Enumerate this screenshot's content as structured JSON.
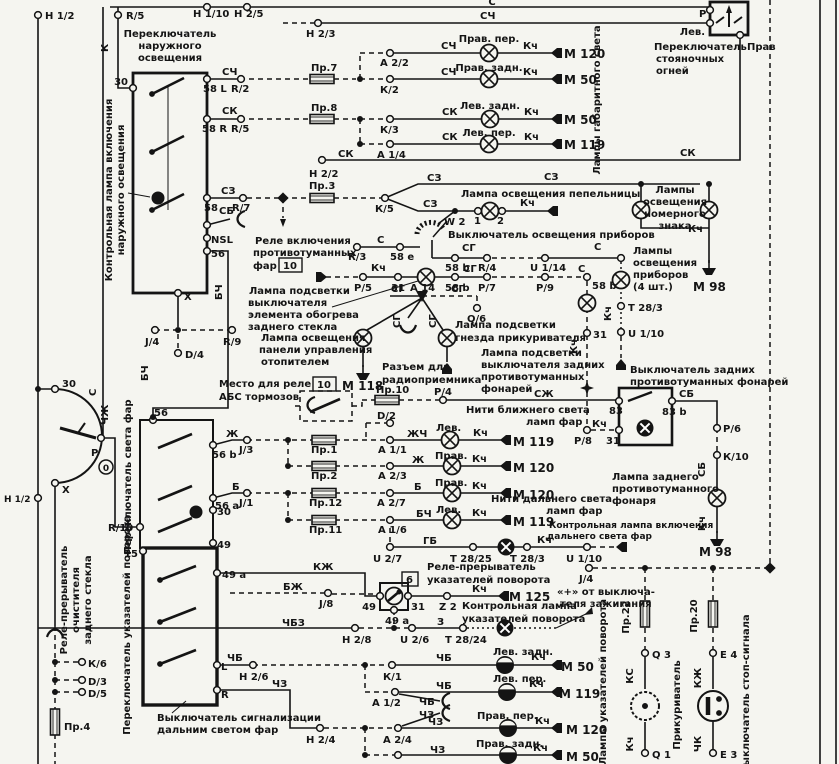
{
  "diagram": {
    "type": "automotive-wiring-schematic",
    "language": "ru",
    "line_color": "#141414",
    "paper_color": "#f5f5f0"
  },
  "labels": [
    {
      "t": "Н 1/2",
      "x": 45,
      "y": 19
    },
    {
      "t": "R/5",
      "x": 126,
      "y": 19
    },
    {
      "t": "К",
      "x": 108,
      "y": 52,
      "r": -90
    },
    {
      "t": "Переключатель",
      "x": 170,
      "y": 37,
      "a": "m"
    },
    {
      "t": "наружного",
      "x": 170,
      "y": 49,
      "a": "m"
    },
    {
      "t": "освещения",
      "x": 170,
      "y": 61,
      "a": "m"
    },
    {
      "t": "30",
      "x": 128,
      "y": 85,
      "a": "e"
    },
    {
      "t": "С",
      "x": 492,
      "y": 5,
      "a": "m"
    },
    {
      "t": "Н 1/10",
      "x": 193,
      "y": 17
    },
    {
      "t": "Н 2/5",
      "x": 234,
      "y": 17
    },
    {
      "t": "СЧ",
      "x": 480,
      "y": 19
    },
    {
      "t": "Н 2/3",
      "x": 306,
      "y": 37
    },
    {
      "t": "СЧ",
      "x": 222,
      "y": 75
    },
    {
      "t": "58 L",
      "x": 203,
      "y": 92
    },
    {
      "t": "R/2",
      "x": 231,
      "y": 92
    },
    {
      "t": "СК",
      "x": 222,
      "y": 114
    },
    {
      "t": "58 R",
      "x": 202,
      "y": 132
    },
    {
      "t": "R/5",
      "x": 231,
      "y": 132
    },
    {
      "t": "СЗ",
      "x": 221,
      "y": 194
    },
    {
      "t": "58",
      "x": 204,
      "y": 211
    },
    {
      "t": "R/7",
      "x": 232,
      "y": 211
    },
    {
      "t": "СБ",
      "x": 219,
      "y": 214
    },
    {
      "t": "NSL",
      "x": 211,
      "y": 243
    },
    {
      "t": "56",
      "x": 211,
      "y": 257
    },
    {
      "t": "X",
      "x": 184,
      "y": 300
    },
    {
      "t": "Контрольная лампа включения",
      "x": 112,
      "y": 190,
      "r": -90,
      "a": "m"
    },
    {
      "t": "наружного освещения",
      "x": 124,
      "y": 190,
      "r": -90,
      "a": "m"
    },
    {
      "t": "Пр.7",
      "x": 311,
      "y": 71
    },
    {
      "t": "А 2/2",
      "x": 380,
      "y": 66
    },
    {
      "t": "СЧ",
      "x": 441,
      "y": 49
    },
    {
      "t": "Прав. пер.",
      "x": 489,
      "y": 42,
      "a": "m"
    },
    {
      "t": "Кч",
      "x": 523,
      "y": 49
    },
    {
      "t": "М 120",
      "x": 564,
      "y": 58,
      "s": 12
    },
    {
      "t": "Прав. задн.",
      "x": 489,
      "y": 71,
      "a": "m"
    },
    {
      "t": "К/2",
      "x": 380,
      "y": 93
    },
    {
      "t": "СЧ",
      "x": 441,
      "y": 75
    },
    {
      "t": "Кч",
      "x": 523,
      "y": 75
    },
    {
      "t": "М 50",
      "x": 564,
      "y": 84,
      "s": 12
    },
    {
      "t": "Пр.8",
      "x": 311,
      "y": 111
    },
    {
      "t": "Лев. задн.",
      "x": 490,
      "y": 109,
      "a": "m"
    },
    {
      "t": "К/3",
      "x": 380,
      "y": 133
    },
    {
      "t": "СК",
      "x": 442,
      "y": 115
    },
    {
      "t": "Кч",
      "x": 524,
      "y": 115
    },
    {
      "t": "М 50",
      "x": 564,
      "y": 124,
      "s": 12
    },
    {
      "t": "Лев. пер.",
      "x": 489,
      "y": 136,
      "a": "m"
    },
    {
      "t": "А 1/4",
      "x": 377,
      "y": 158
    },
    {
      "t": "СК",
      "x": 442,
      "y": 140
    },
    {
      "t": "Кч",
      "x": 524,
      "y": 140
    },
    {
      "t": "М 119",
      "x": 564,
      "y": 149,
      "s": 12
    },
    {
      "t": "СК",
      "x": 338,
      "y": 157
    },
    {
      "t": "Н 2/2",
      "x": 309,
      "y": 177
    },
    {
      "t": "Лампы габаритного света",
      "x": 600,
      "y": 100,
      "r": -90,
      "a": "m"
    },
    {
      "t": "Лев.",
      "x": 705,
      "y": 35,
      "a": "e"
    },
    {
      "t": "Переключатель",
      "x": 654,
      "y": 50
    },
    {
      "t": "стояночных",
      "x": 656,
      "y": 62
    },
    {
      "t": "огней",
      "x": 656,
      "y": 74
    },
    {
      "t": "Прав",
      "x": 747,
      "y": 50
    },
    {
      "t": "Р",
      "x": 699,
      "y": 17
    },
    {
      "t": "СК",
      "x": 680,
      "y": 156
    },
    {
      "t": "Пр.3",
      "x": 309,
      "y": 189
    },
    {
      "t": "К/5",
      "x": 375,
      "y": 212
    },
    {
      "t": "СЗ",
      "x": 427,
      "y": 181
    },
    {
      "t": "СЗ",
      "x": 423,
      "y": 207
    },
    {
      "t": "Лампа освещения пепельницы",
      "x": 461,
      "y": 197
    },
    {
      "t": "СЗ",
      "x": 544,
      "y": 180
    },
    {
      "t": "W 2",
      "x": 444,
      "y": 225
    },
    {
      "t": "1",
      "x": 474,
      "y": 224
    },
    {
      "t": "2",
      "x": 497,
      "y": 224
    },
    {
      "t": "Кч",
      "x": 520,
      "y": 206
    },
    {
      "t": "Выключатель освещения приборов",
      "x": 448,
      "y": 238
    },
    {
      "t": "С",
      "x": 377,
      "y": 243
    },
    {
      "t": "R/3",
      "x": 348,
      "y": 260
    },
    {
      "t": "58 е",
      "x": 390,
      "y": 260
    },
    {
      "t": "СГ",
      "x": 462,
      "y": 251
    },
    {
      "t": "58 b",
      "x": 445,
      "y": 271
    },
    {
      "t": "R/4",
      "x": 478,
      "y": 271
    },
    {
      "t": "U 1/14",
      "x": 530,
      "y": 271
    },
    {
      "t": "С",
      "x": 594,
      "y": 250
    },
    {
      "t": "Реле включения",
      "x": 255,
      "y": 244
    },
    {
      "t": "противотуманных",
      "x": 253,
      "y": 256
    },
    {
      "t": "фар",
      "x": 253,
      "y": 269
    },
    {
      "t": "10",
      "x": 283,
      "y": 269,
      "b": true
    },
    {
      "t": "Кч",
      "x": 371,
      "y": 271
    },
    {
      "t": "Р/5",
      "x": 354,
      "y": 291
    },
    {
      "t": "31",
      "x": 391,
      "y": 291
    },
    {
      "t": "58 b",
      "x": 445,
      "y": 291
    },
    {
      "t": "Р/7",
      "x": 478,
      "y": 291
    },
    {
      "t": "СГ",
      "x": 463,
      "y": 272
    },
    {
      "t": "Р/9",
      "x": 536,
      "y": 291
    },
    {
      "t": "Лампа подсветки",
      "x": 249,
      "y": 294
    },
    {
      "t": "выключателя",
      "x": 248,
      "y": 306
    },
    {
      "t": "элемента обогрева",
      "x": 248,
      "y": 318
    },
    {
      "t": "заднего стекла",
      "x": 248,
      "y": 330
    },
    {
      "t": "СГ",
      "x": 391,
      "y": 292
    },
    {
      "t": "А 14",
      "x": 410,
      "y": 291
    },
    {
      "t": "СГ",
      "x": 451,
      "y": 292
    },
    {
      "t": "Q/6",
      "x": 467,
      "y": 322
    },
    {
      "t": "СГ",
      "x": 400,
      "y": 328,
      "r": -90
    },
    {
      "t": "СГ",
      "x": 436,
      "y": 328,
      "r": -90
    },
    {
      "t": "Лампа освещения",
      "x": 261,
      "y": 341
    },
    {
      "t": "панели управления",
      "x": 259,
      "y": 353
    },
    {
      "t": "отопителем",
      "x": 261,
      "y": 365
    },
    {
      "t": "М 118",
      "x": 342,
      "y": 390,
      "s": 12
    },
    {
      "t": "Разъем для",
      "x": 382,
      "y": 370
    },
    {
      "t": "радиоприемника",
      "x": 382,
      "y": 383
    },
    {
      "t": "Лампа подсветки",
      "x": 455,
      "y": 328
    },
    {
      "t": "гнезда прикуривателя",
      "x": 455,
      "y": 341
    },
    {
      "t": "Лампа подсветки",
      "x": 481,
      "y": 356
    },
    {
      "t": "выключателя задних",
      "x": 481,
      "y": 368
    },
    {
      "t": "противотуманных",
      "x": 481,
      "y": 380
    },
    {
      "t": "фонарей",
      "x": 481,
      "y": 392
    },
    {
      "t": "Лампы",
      "x": 675,
      "y": 193,
      "a": "m"
    },
    {
      "t": "освещения",
      "x": 675,
      "y": 205,
      "a": "m"
    },
    {
      "t": "номерного",
      "x": 675,
      "y": 217,
      "a": "m"
    },
    {
      "t": "знака",
      "x": 675,
      "y": 229,
      "a": "m"
    },
    {
      "t": "Кч",
      "x": 688,
      "y": 232
    },
    {
      "t": "М 98",
      "x": 693,
      "y": 291,
      "s": 12
    },
    {
      "t": "Лампы",
      "x": 633,
      "y": 254
    },
    {
      "t": "освещения",
      "x": 633,
      "y": 266
    },
    {
      "t": "приборов",
      "x": 633,
      "y": 278
    },
    {
      "t": "(4 шт.)",
      "x": 633,
      "y": 290
    },
    {
      "t": "Т 28/3",
      "x": 628,
      "y": 311
    },
    {
      "t": "Кч",
      "x": 611,
      "y": 321,
      "r": -90
    },
    {
      "t": "U 1/10",
      "x": 628,
      "y": 337
    },
    {
      "t": "С",
      "x": 578,
      "y": 272
    },
    {
      "t": "58 b",
      "x": 592,
      "y": 289
    },
    {
      "t": "31",
      "x": 593,
      "y": 338
    },
    {
      "t": "Кч",
      "x": 577,
      "y": 354,
      "r": -90
    },
    {
      "t": "Выключатель задних",
      "x": 630,
      "y": 373
    },
    {
      "t": "противотуманных фонарей",
      "x": 630,
      "y": 385
    },
    {
      "t": "СЖ",
      "x": 534,
      "y": 397
    },
    {
      "t": "83",
      "x": 609,
      "y": 414
    },
    {
      "t": "СБ",
      "x": 679,
      "y": 397
    },
    {
      "t": "83 b",
      "x": 662,
      "y": 415
    },
    {
      "t": "Кч",
      "x": 592,
      "y": 427
    },
    {
      "t": "Р/8",
      "x": 574,
      "y": 444
    },
    {
      "t": "31",
      "x": 606,
      "y": 444
    },
    {
      "t": "Р/6",
      "x": 723,
      "y": 432
    },
    {
      "t": "К/10",
      "x": 723,
      "y": 460
    },
    {
      "t": "СБ",
      "x": 705,
      "y": 477,
      "r": -90
    },
    {
      "t": "Лампа заднего",
      "x": 612,
      "y": 480
    },
    {
      "t": "противотуманного",
      "x": 612,
      "y": 492
    },
    {
      "t": "фонаря",
      "x": 612,
      "y": 504
    },
    {
      "t": "Кч",
      "x": 705,
      "y": 531,
      "r": -90
    },
    {
      "t": "М 98",
      "x": 699,
      "y": 556,
      "s": 12
    },
    {
      "t": "Место для реле",
      "x": 219,
      "y": 387
    },
    {
      "t": "АБС тормозов",
      "x": 219,
      "y": 400
    },
    {
      "t": "10",
      "x": 317,
      "y": 388,
      "b": true
    },
    {
      "t": "Пр.10",
      "x": 376,
      "y": 393
    },
    {
      "t": "Р/4",
      "x": 434,
      "y": 395
    },
    {
      "t": "Нити ближнего света",
      "x": 466,
      "y": 413
    },
    {
      "t": "ламп фар",
      "x": 526,
      "y": 425
    },
    {
      "t": "Лев.",
      "x": 436,
      "y": 431
    },
    {
      "t": "D/2",
      "x": 377,
      "y": 419
    },
    {
      "t": "ЖЧ",
      "x": 407,
      "y": 437
    },
    {
      "t": "А 1/1",
      "x": 378,
      "y": 453
    },
    {
      "t": "Кч",
      "x": 473,
      "y": 436
    },
    {
      "t": "М 119",
      "x": 513,
      "y": 446,
      "s": 12
    },
    {
      "t": "Прав.",
      "x": 435,
      "y": 459
    },
    {
      "t": "Ж",
      "x": 412,
      "y": 463
    },
    {
      "t": "А 2/3",
      "x": 378,
      "y": 479
    },
    {
      "t": "Кч",
      "x": 472,
      "y": 462
    },
    {
      "t": "М 120",
      "x": 513,
      "y": 472,
      "s": 12
    },
    {
      "t": "Ж",
      "x": 226,
      "y": 437
    },
    {
      "t": "J/3",
      "x": 239,
      "y": 453
    },
    {
      "t": "Пр.1",
      "x": 311,
      "y": 453
    },
    {
      "t": "Пр.2",
      "x": 311,
      "y": 479
    },
    {
      "t": "Б",
      "x": 232,
      "y": 490
    },
    {
      "t": "56 a",
      "x": 215,
      "y": 509
    },
    {
      "t": "J/1",
      "x": 239,
      "y": 506
    },
    {
      "t": "Прав.",
      "x": 435,
      "y": 486
    },
    {
      "t": "Б",
      "x": 414,
      "y": 490
    },
    {
      "t": "А 2/7",
      "x": 377,
      "y": 506
    },
    {
      "t": "Кч",
      "x": 472,
      "y": 489
    },
    {
      "t": "М 120",
      "x": 513,
      "y": 499,
      "s": 12
    },
    {
      "t": "Нити дальнего света",
      "x": 491,
      "y": 502
    },
    {
      "t": "ламп фар",
      "x": 546,
      "y": 514
    },
    {
      "t": "Пр.12",
      "x": 309,
      "y": 506
    },
    {
      "t": "Пр.11",
      "x": 309,
      "y": 533
    },
    {
      "t": "Лев.",
      "x": 436,
      "y": 513
    },
    {
      "t": "БЧ",
      "x": 416,
      "y": 517
    },
    {
      "t": "А 1/6",
      "x": 378,
      "y": 533
    },
    {
      "t": "Кч",
      "x": 472,
      "y": 516
    },
    {
      "t": "М 119",
      "x": 513,
      "y": 526,
      "s": 12
    },
    {
      "t": "ГБ",
      "x": 423,
      "y": 544
    },
    {
      "t": "U 2/7",
      "x": 373,
      "y": 562
    },
    {
      "t": "Т 28/25",
      "x": 450,
      "y": 562
    },
    {
      "t": "Т 28/3",
      "x": 510,
      "y": 562
    },
    {
      "t": "Кч",
      "x": 537,
      "y": 543
    },
    {
      "t": "U 1/10",
      "x": 566,
      "y": 562
    },
    {
      "t": "Контрольная лампа включения",
      "x": 549,
      "y": 528,
      "s": 9
    },
    {
      "t": "дальнего света фар",
      "x": 547,
      "y": 539,
      "s": 9
    },
    {
      "t": "56",
      "x": 154,
      "y": 416
    },
    {
      "t": "56 b",
      "x": 212,
      "y": 458
    },
    {
      "t": "30",
      "x": 217,
      "y": 515
    },
    {
      "t": "49",
      "x": 217,
      "y": 548
    },
    {
      "t": "R/10",
      "x": 108,
      "y": 531
    },
    {
      "t": "ЧЖ",
      "x": 108,
      "y": 425,
      "r": -90
    },
    {
      "t": "С",
      "x": 96,
      "y": 396,
      "r": -90
    },
    {
      "t": "Переключатель света фар",
      "x": 131,
      "y": 477,
      "r": -90,
      "a": "m"
    },
    {
      "t": "30",
      "x": 62,
      "y": 387
    },
    {
      "t": "P",
      "x": 91,
      "y": 456
    },
    {
      "t": "X",
      "x": 62,
      "y": 493
    },
    {
      "t": "0",
      "x": 106,
      "y": 471,
      "a": "m",
      "s": 9
    },
    {
      "t": "Н 1/2",
      "x": 4,
      "y": 502,
      "s": 9
    },
    {
      "t": "БЧ",
      "x": 222,
      "y": 300,
      "r": -90
    },
    {
      "t": "БЧ",
      "x": 148,
      "y": 381,
      "r": -90
    },
    {
      "t": "J/4",
      "x": 145,
      "y": 345
    },
    {
      "t": "R/9",
      "x": 223,
      "y": 345
    },
    {
      "t": "D/4",
      "x": 185,
      "y": 358
    },
    {
      "t": "15",
      "x": 138,
      "y": 557,
      "a": "e"
    },
    {
      "t": "49 a",
      "x": 222,
      "y": 578
    },
    {
      "t": "Переключатель указателей поворота",
      "x": 130,
      "y": 625,
      "r": -90,
      "a": "m"
    },
    {
      "t": "L",
      "x": 221,
      "y": 670
    },
    {
      "t": "R",
      "x": 221,
      "y": 698
    },
    {
      "t": "Выключатель сигнализации",
      "x": 157,
      "y": 721
    },
    {
      "t": "дальним светом фар",
      "x": 157,
      "y": 733
    },
    {
      "t": "Реле-прерыватель",
      "x": 67,
      "y": 600,
      "r": -90,
      "a": "m"
    },
    {
      "t": "очистителя",
      "x": 79,
      "y": 600,
      "r": -90,
      "a": "m"
    },
    {
      "t": "заднего стекла",
      "x": 91,
      "y": 600,
      "r": -90,
      "a": "m"
    },
    {
      "t": "К/6",
      "x": 88,
      "y": 667
    },
    {
      "t": "D/3",
      "x": 88,
      "y": 685
    },
    {
      "t": "D/5",
      "x": 88,
      "y": 697
    },
    {
      "t": "Пр.4",
      "x": 64,
      "y": 730
    },
    {
      "t": "КЖ",
      "x": 313,
      "y": 570
    },
    {
      "t": "Реле-прерыватель",
      "x": 427,
      "y": 570
    },
    {
      "t": "6",
      "x": 406,
      "y": 583,
      "b": true
    },
    {
      "t": "указателей поворота",
      "x": 427,
      "y": 583
    },
    {
      "t": "БЖ",
      "x": 283,
      "y": 590
    },
    {
      "t": "J/8",
      "x": 319,
      "y": 607
    },
    {
      "t": "49",
      "x": 376,
      "y": 610,
      "a": "e"
    },
    {
      "t": "31",
      "x": 411,
      "y": 610
    },
    {
      "t": "49 a",
      "x": 385,
      "y": 624
    },
    {
      "t": "Z 2",
      "x": 439,
      "y": 610
    },
    {
      "t": "Кч",
      "x": 472,
      "y": 592
    },
    {
      "t": "М 125",
      "x": 509,
      "y": 601,
      "s": 12
    },
    {
      "t": "Контрольная лампа",
      "x": 462,
      "y": 609
    },
    {
      "t": "указателей поворота",
      "x": 462,
      "y": 622
    },
    {
      "t": "«+» от выключа-",
      "x": 557,
      "y": 595
    },
    {
      "t": "теля зажигания",
      "x": 560,
      "y": 607
    },
    {
      "t": "ЧБЗ",
      "x": 282,
      "y": 626
    },
    {
      "t": "Н 2/8",
      "x": 342,
      "y": 643
    },
    {
      "t": "U 2/6",
      "x": 400,
      "y": 643
    },
    {
      "t": "З",
      "x": 437,
      "y": 625
    },
    {
      "t": "Т 28/24",
      "x": 445,
      "y": 643
    },
    {
      "t": "Лев. задн.",
      "x": 493,
      "y": 655
    },
    {
      "t": "ЧБ",
      "x": 436,
      "y": 661
    },
    {
      "t": "Кч",
      "x": 531,
      "y": 660
    },
    {
      "t": "М 50",
      "x": 561,
      "y": 671,
      "s": 12
    },
    {
      "t": "ЧБ",
      "x": 227,
      "y": 661
    },
    {
      "t": "Н 2/6",
      "x": 239,
      "y": 680
    },
    {
      "t": "К/1",
      "x": 383,
      "y": 680
    },
    {
      "t": "Лев. пер.",
      "x": 493,
      "y": 682
    },
    {
      "t": "ЧБ",
      "x": 436,
      "y": 689
    },
    {
      "t": "Кч",
      "x": 529,
      "y": 687
    },
    {
      "t": "М 119",
      "x": 559,
      "y": 698,
      "s": 12
    },
    {
      "t": "А 1/2",
      "x": 372,
      "y": 706
    },
    {
      "t": "ЧБ",
      "x": 419,
      "y": 705
    },
    {
      "t": "ЧЗ",
      "x": 419,
      "y": 718
    },
    {
      "t": "ЧЗ",
      "x": 272,
      "y": 687
    },
    {
      "t": "Прав. пер.",
      "x": 477,
      "y": 719
    },
    {
      "t": "ЧЗ",
      "x": 428,
      "y": 725
    },
    {
      "t": "Н 2/4",
      "x": 306,
      "y": 743
    },
    {
      "t": "А 2/4",
      "x": 383,
      "y": 743
    },
    {
      "t": "Кч",
      "x": 535,
      "y": 724
    },
    {
      "t": "М 120",
      "x": 566,
      "y": 734,
      "s": 12
    },
    {
      "t": "Прав. задн.",
      "x": 476,
      "y": 747
    },
    {
      "t": "ЧЗ",
      "x": 430,
      "y": 753
    },
    {
      "t": "Кч",
      "x": 533,
      "y": 751
    },
    {
      "t": "М 50",
      "x": 566,
      "y": 761,
      "s": 12
    },
    {
      "t": "Лампы указателей поворота",
      "x": 606,
      "y": 682,
      "r": -90,
      "a": "m"
    },
    {
      "t": "J/4",
      "x": 579,
      "y": 582
    },
    {
      "t": "Пр.22",
      "x": 629,
      "y": 617,
      "r": -90,
      "a": "m"
    },
    {
      "t": "Q 3",
      "x": 652,
      "y": 658
    },
    {
      "t": "КС",
      "x": 633,
      "y": 676,
      "r": -90,
      "a": "m"
    },
    {
      "t": "Прикуриватель",
      "x": 680,
      "y": 705,
      "r": -90,
      "a": "m"
    },
    {
      "t": "Кч",
      "x": 633,
      "y": 744,
      "r": -90,
      "a": "m"
    },
    {
      "t": "Q 1",
      "x": 652,
      "y": 758
    },
    {
      "t": "Пр.20",
      "x": 697,
      "y": 616,
      "r": -90,
      "a": "m"
    },
    {
      "t": "Е 4",
      "x": 720,
      "y": 658
    },
    {
      "t": "КЖ",
      "x": 701,
      "y": 678,
      "r": -90,
      "a": "m"
    },
    {
      "t": "Выключатель стоп-сигнала",
      "x": 749,
      "y": 694,
      "r": -90,
      "a": "m"
    },
    {
      "t": "ЧК",
      "x": 701,
      "y": 744,
      "r": -90,
      "a": "m"
    },
    {
      "t": "Е 3",
      "x": 720,
      "y": 758
    }
  ]
}
